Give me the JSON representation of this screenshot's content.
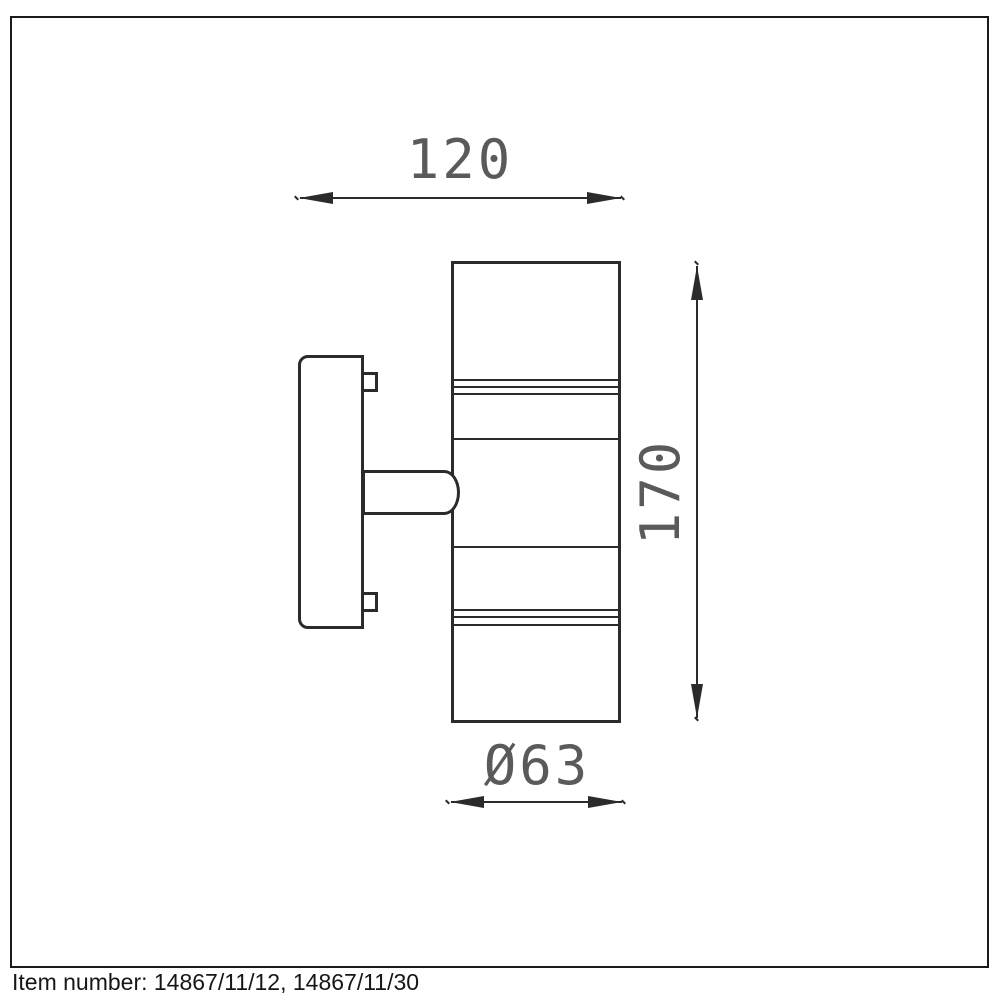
{
  "colors": {
    "background": "#ffffff",
    "frame_border": "#1a1a1a",
    "drawing_line": "#2b2b2b",
    "dimension_text": "#5a5a5a",
    "footer_text": "#161616"
  },
  "drawing": {
    "subject": "wall-mounted-up-down-cylinder-spotlight-side-view",
    "dimensions": {
      "width_label": "120",
      "height_label": "170",
      "diameter_label": "Ø63"
    }
  },
  "footer": {
    "item_number": "Item number: 14867/11/12, 14867/11/30"
  }
}
